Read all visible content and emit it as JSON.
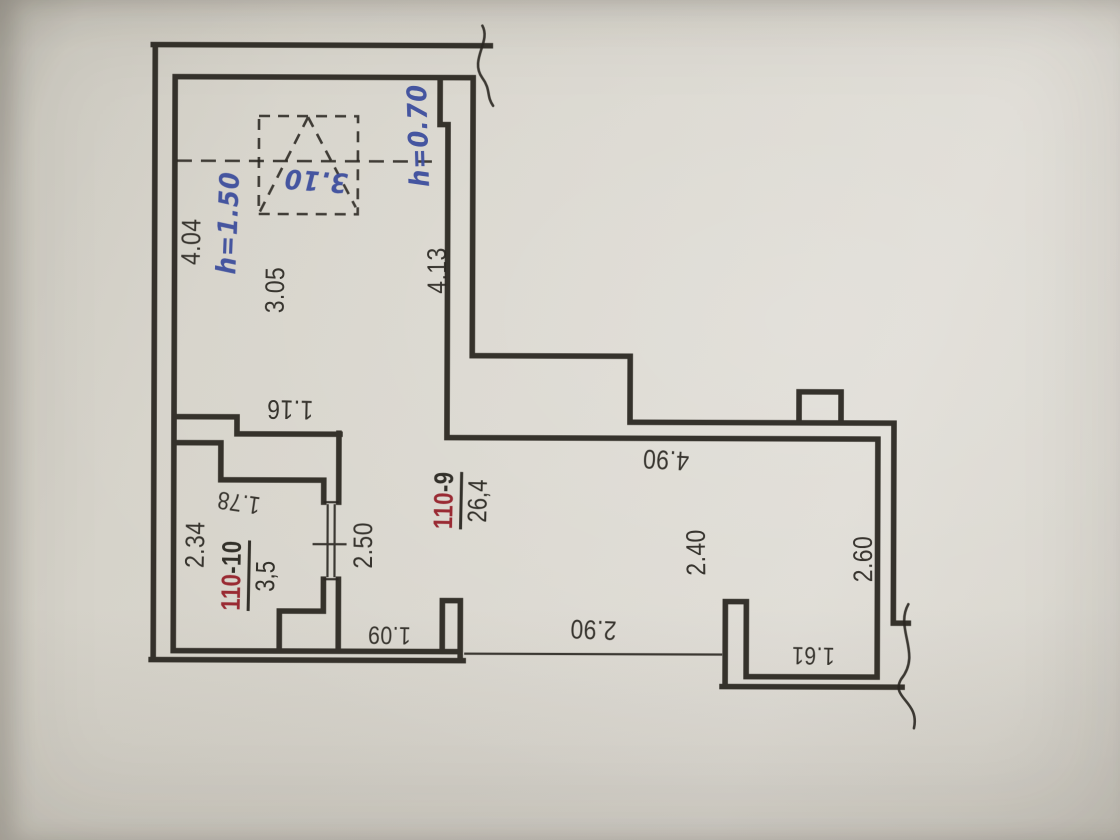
{
  "plan": {
    "rooms": [
      {
        "id_red": "110",
        "id_suffix": "-9",
        "area": "26,4"
      },
      {
        "id_red": "110",
        "id_suffix": "-10",
        "area": "3,5"
      }
    ],
    "dimensions": {
      "top_room_height": "4.04",
      "top_room_width": "3.05",
      "top_room_right_height": "4.13",
      "ledge_width": "1.16",
      "small_room_height": "2.34",
      "small_room_width": "1.78",
      "passage_height": "2.50",
      "hall_width": "4.90",
      "hall_height": "2.40",
      "right_room_height": "2.60",
      "opening_width": "2.90",
      "doorway_width": "1.09",
      "right_room_width": "1.61"
    },
    "handwritten": {
      "skylight_size": "3.10",
      "ceiling_height_left": "h=1.50",
      "ceiling_height_right": "h=0.70"
    },
    "colors": {
      "ink": "#2a2721",
      "stamp_red": "#96212b",
      "pen_blue": "#3e4f9e",
      "paper": "#d8d5cc"
    }
  }
}
